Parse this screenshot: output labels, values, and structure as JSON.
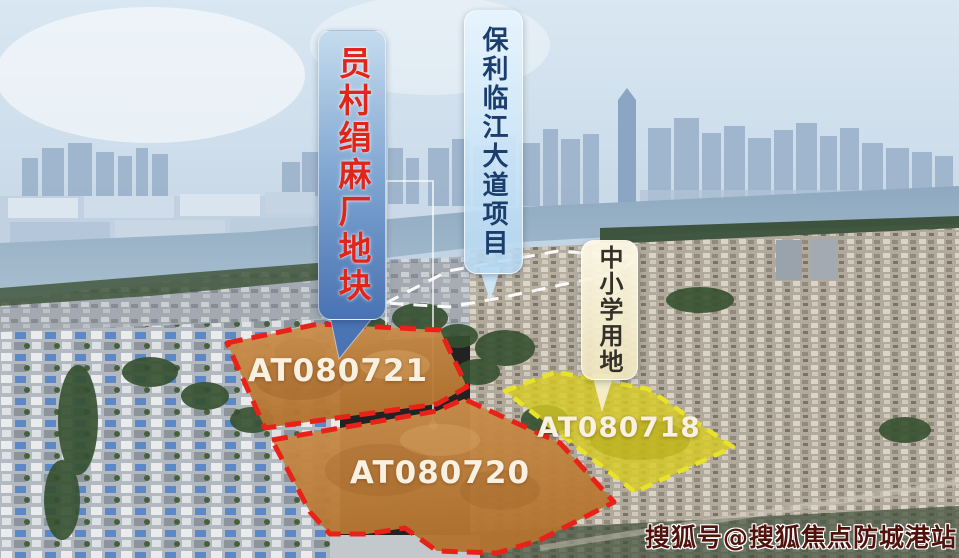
{
  "callouts": {
    "factory": {
      "label": "员村绢麻厂地块",
      "text_color": "#e0251b",
      "bg_top": "#c5dcee",
      "bg_bottom": "#4872b2"
    },
    "project": {
      "label": "保利临江大道项目",
      "text_color": "#1c3e6d",
      "bg": "#d9edfa"
    },
    "school": {
      "label": "中小学用地",
      "text_color": "#33302a",
      "bg": "#f7f1d4"
    }
  },
  "plots": {
    "plot_721": {
      "id": "AT080721",
      "outline_color": "#ea2118",
      "fill_color": "#c9853f"
    },
    "plot_720": {
      "id": "AT080720",
      "outline_color": "#ea2118",
      "fill_color": "#c9853f"
    },
    "plot_718": {
      "id": "AT080718",
      "outline_color": "#e9e22a",
      "fill_color": "#d5c925"
    }
  },
  "project_area": {
    "outline_color": "#ffffff"
  },
  "watermark": {
    "text": "搜狐号@搜狐焦点防城港站",
    "color": "#4f120c"
  }
}
